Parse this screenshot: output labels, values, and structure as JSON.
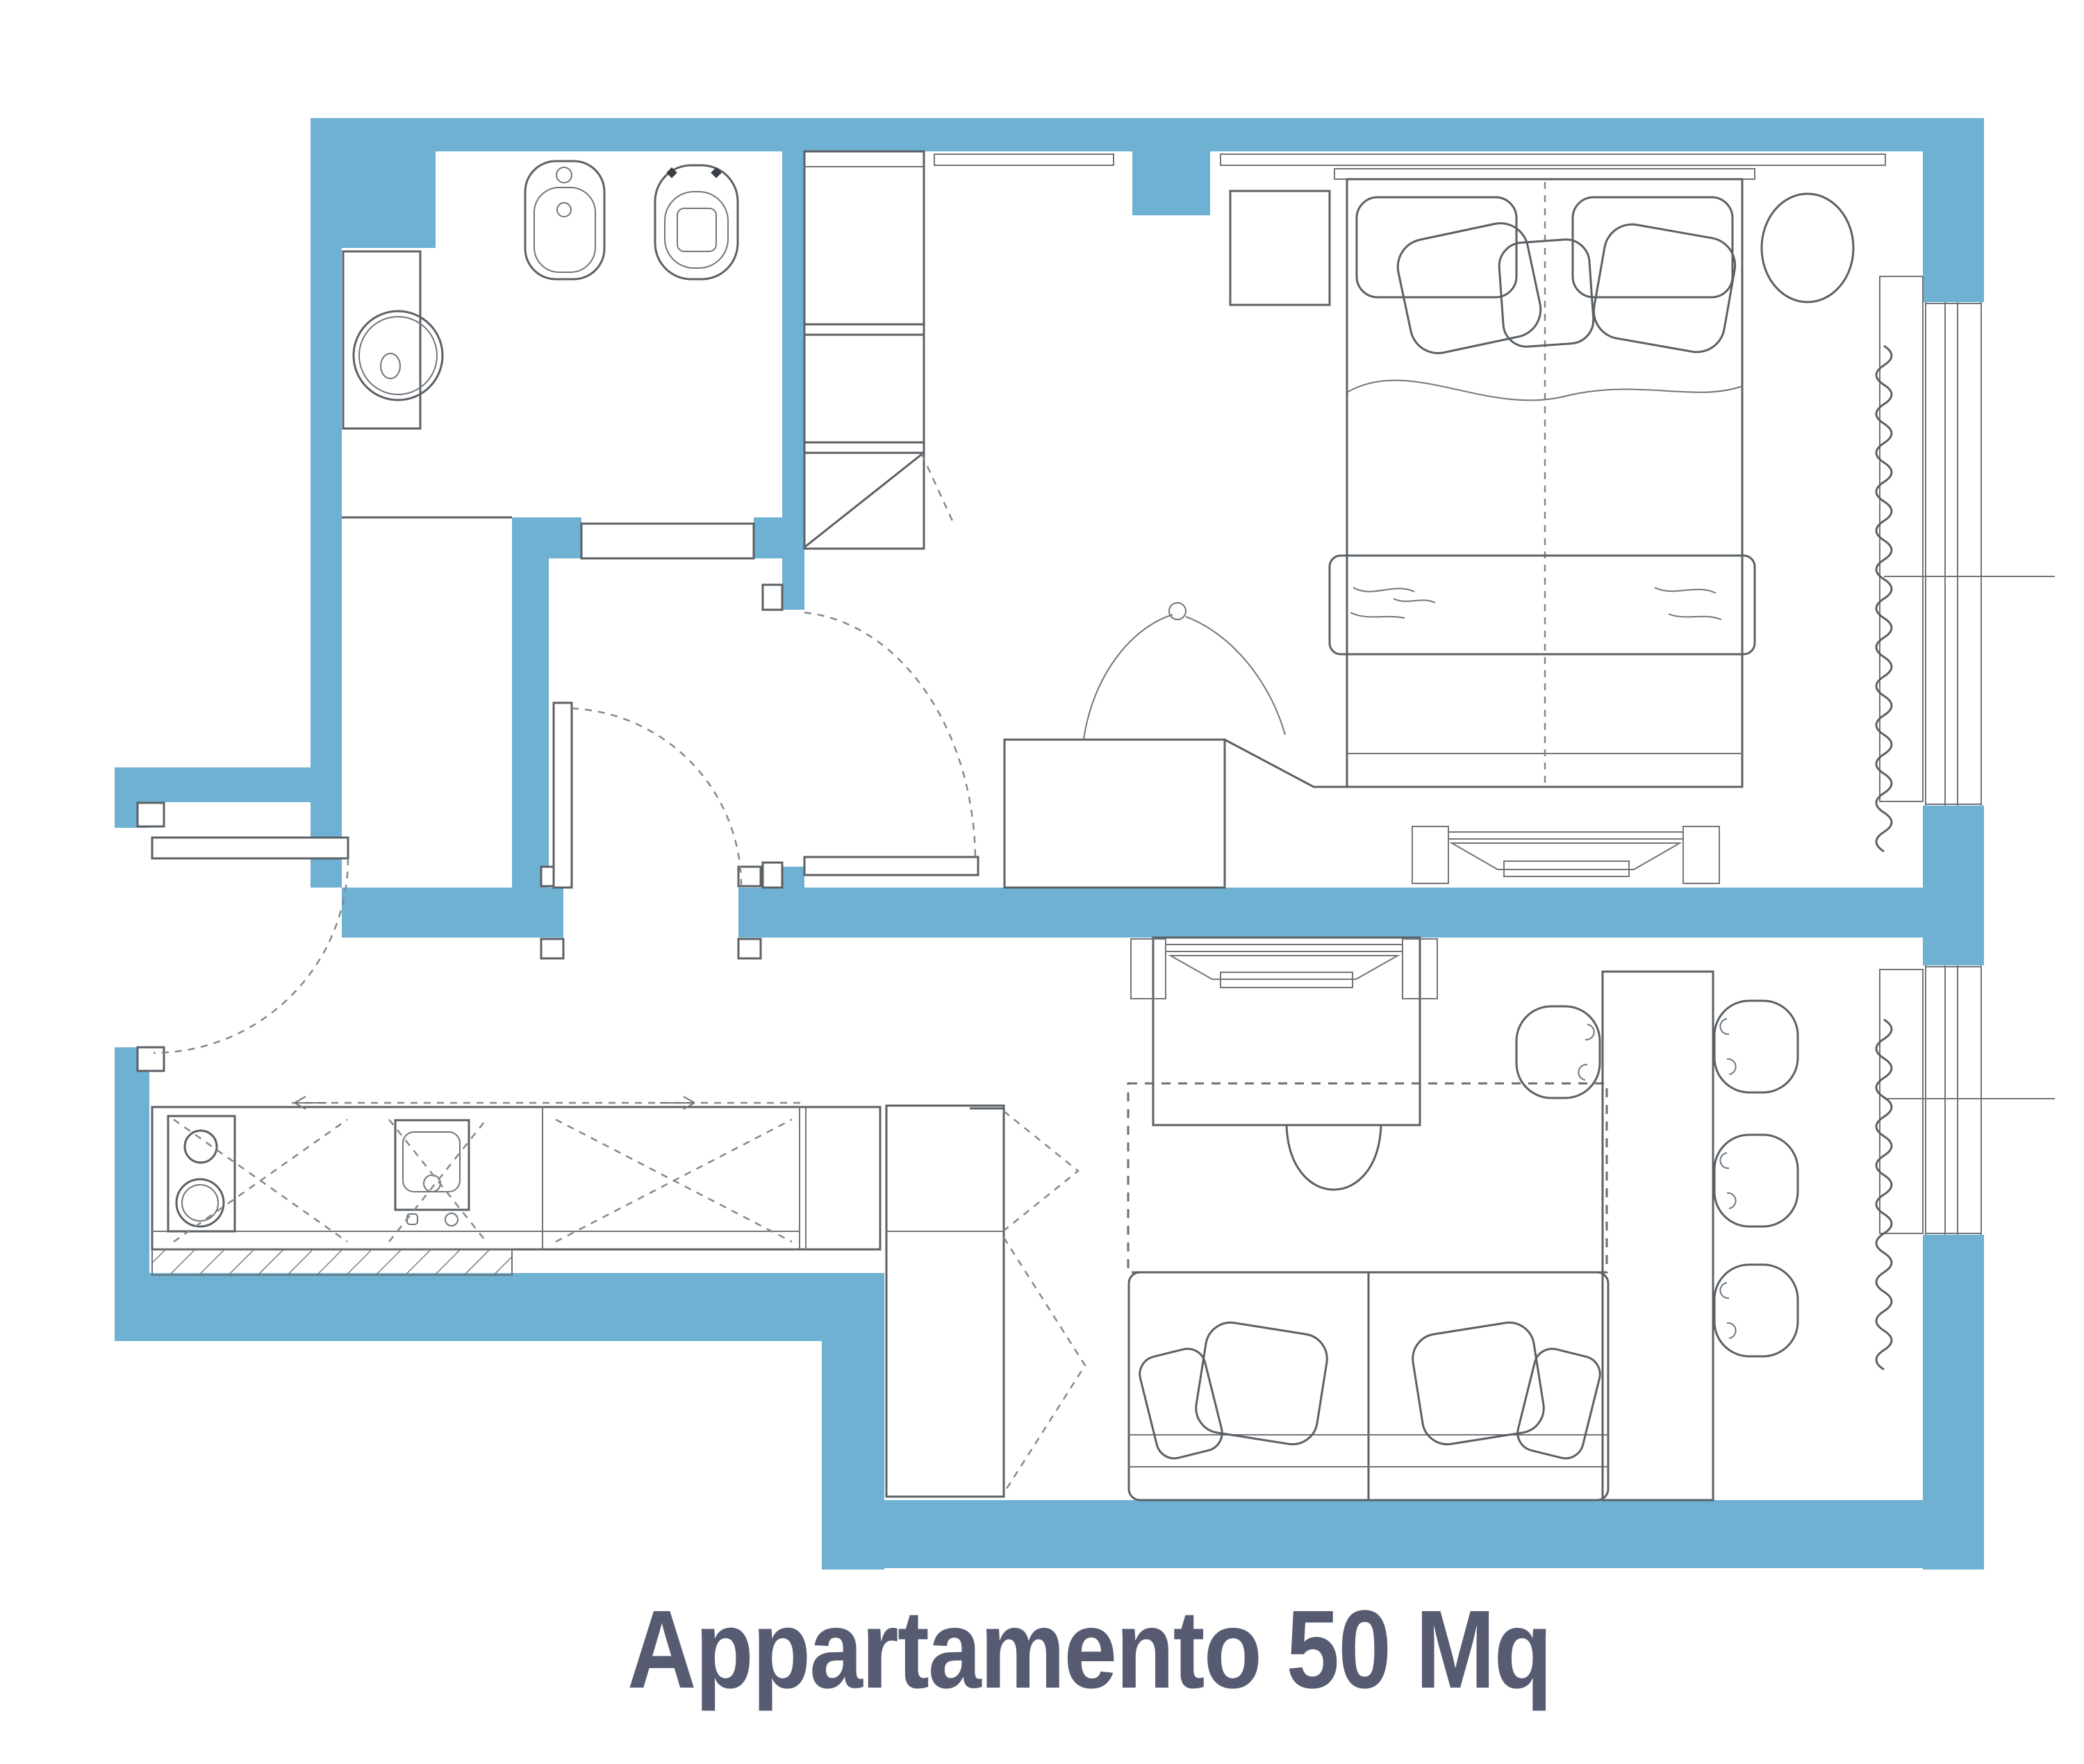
{
  "title": {
    "text": "Appartamento 50 Mq"
  },
  "colors": {
    "wall": "#6FB1D2",
    "title": "#565B72",
    "line": "#5B6065"
  }
}
